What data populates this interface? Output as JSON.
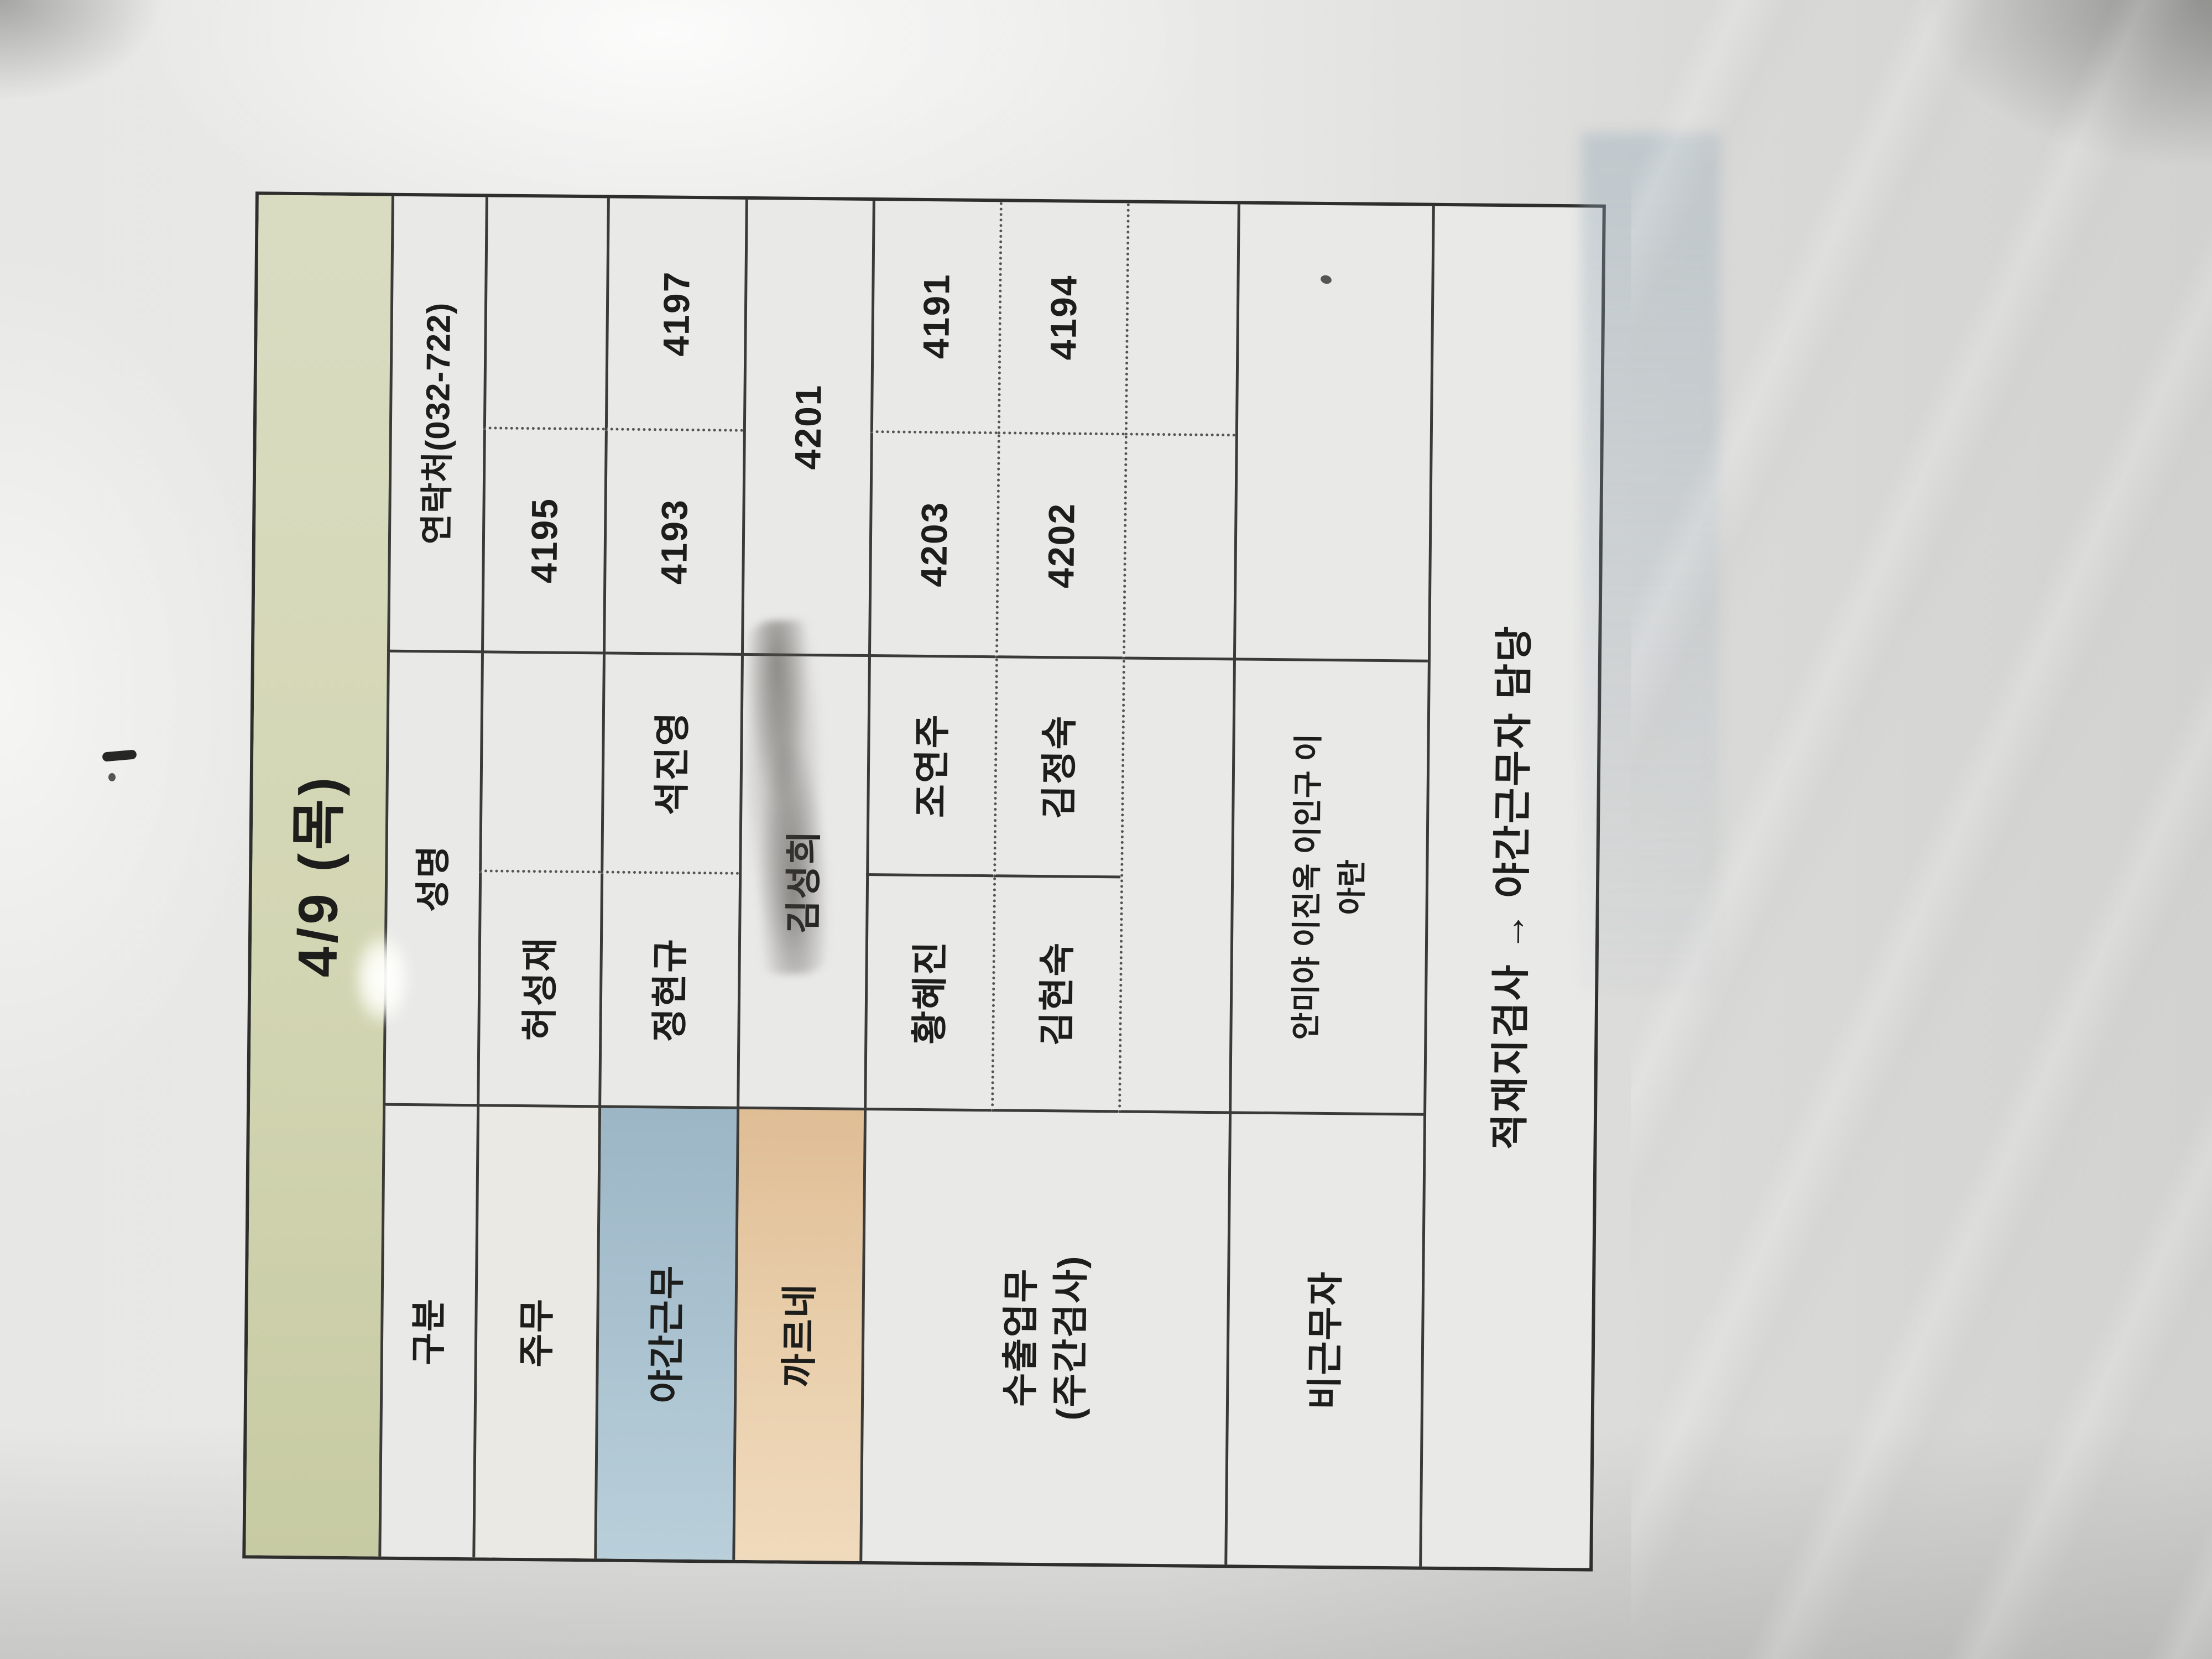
{
  "schedule_table": {
    "title": "4/9 (목)",
    "columns": {
      "category": "구분",
      "name": "성명",
      "contact": "연락처(032-722)"
    },
    "rows": [
      {
        "category": "주무",
        "name_left": "허성재",
        "name_right": "",
        "contact_left": "4195",
        "contact_right": ""
      },
      {
        "category": "야간근무",
        "name_left": "정현규",
        "name_right": "석진영",
        "contact_left": "4193",
        "contact_right": "4197"
      },
      {
        "category": "까르네",
        "name": "김성희",
        "contact": "4201"
      },
      {
        "category": "수출업무\n(주간검사)",
        "subrows": [
          {
            "name_left": "황혜진",
            "name_right": "조연주",
            "contact_left": "4203",
            "contact_right": "4191"
          },
          {
            "name_left": "김현숙",
            "name_right": "김정숙",
            "contact_left": "4202",
            "contact_right": "4194"
          },
          {
            "name_left": "",
            "name_right": "",
            "contact_left": "",
            "contact_right": ""
          }
        ]
      },
      {
        "category": "비근무자",
        "names": "안미야 이진옥 이인구 이\n아란",
        "contact": ""
      }
    ],
    "footer_note": "적재지검사 → 야간근무자 담당",
    "colors": {
      "title_bg": "#d3d6b3",
      "night_shift_bg": "#a9c1cf",
      "carnet_bg": "#e8cda9",
      "grid_line": "#3a3a38",
      "paper": "#e9e9e7",
      "text": "#1d1d1b"
    },
    "artifacts": {
      "pencil_scribble": "scribbled-out area beside 김성희 in 까르네 row",
      "pen_mark": "small handwritten dash on paper margin above title",
      "glare": "camera glare spots and diagonal reflections on laminated sheet"
    }
  }
}
